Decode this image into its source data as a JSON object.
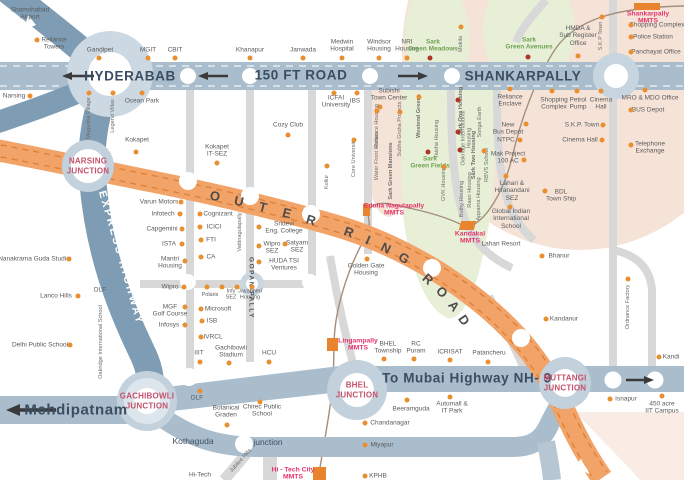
{
  "colors": {
    "outer_ring_road": "#f2a368",
    "orr_dash": "#dd7f35",
    "highway_band": "#a9bdcc",
    "express_highway": "#7e9db4",
    "minor_road": "#d8d8d8",
    "green_zone": "#e7f0d6",
    "peach_zone": "#f6e3d8",
    "junction_ring": "#c3d1dc",
    "label_text": "#5b5b5b",
    "green_label": "#6fa052",
    "mmts_label": "#e5336b",
    "junction_label": "#c4526b",
    "poi_dot": "#ea8f2f",
    "dark_dot": "#ae352a",
    "band_text": "#3b4d61"
  },
  "roads": {
    "hyderabad": "HYDERABAB",
    "road150": "150 FT ROAD",
    "shankarpally": "SHANKARPALLY",
    "nh9": "To Mubai Highway NH- 9",
    "mehdipatnam": "Mehdipatnam",
    "express": "EXPRESS HIGHWAY",
    "orr": "OUTER RING ROAD",
    "orr_letters": [
      {
        "ch": "O",
        "x": 215,
        "y": 196,
        "r": 12
      },
      {
        "ch": "U",
        "x": 239,
        "y": 201,
        "r": 13
      },
      {
        "ch": "T",
        "x": 263,
        "y": 207,
        "r": 14
      },
      {
        "ch": "E",
        "x": 287,
        "y": 213,
        "r": 15
      },
      {
        "ch": "R",
        "x": 311,
        "y": 220,
        "r": 17
      },
      {
        "ch": "R",
        "x": 349,
        "y": 232,
        "r": 20
      },
      {
        "ch": "I",
        "x": 368,
        "y": 240,
        "r": 23
      },
      {
        "ch": "N",
        "x": 386,
        "y": 248,
        "r": 26
      },
      {
        "ch": "G",
        "x": 404,
        "y": 258,
        "r": 30
      },
      {
        "ch": "R",
        "x": 428,
        "y": 279,
        "r": 42
      },
      {
        "ch": "O",
        "x": 442,
        "y": 292,
        "r": 46
      },
      {
        "ch": "A",
        "x": 454,
        "y": 306,
        "r": 50
      },
      {
        "ch": "D",
        "x": 464,
        "y": 320,
        "r": 55
      }
    ]
  },
  "junctions": [
    {
      "name": "narsing-junction",
      "label": "NARSING\nJUNCTION",
      "x": 88,
      "y": 166
    },
    {
      "name": "gachibowli-junction",
      "label": "GACHIBOWLI\nJUNCTION",
      "x": 147,
      "y": 401
    },
    {
      "name": "bhel-junction",
      "label": "BHEL\nJUNCTION",
      "x": 357,
      "y": 390
    },
    {
      "name": "muttangi-junction",
      "label": "MUTTANGI\nJUNCTION",
      "x": 565,
      "y": 383
    }
  ],
  "mmts_stations": [
    {
      "label": "Shankarpally\nMMTS",
      "x": 648,
      "y": 18,
      "block": [
        634,
        3,
        26,
        7,
        0
      ]
    },
    {
      "label": "Edulla Nagulapally\nMMTS",
      "x": 394,
      "y": 210,
      "block": [
        363,
        204,
        7,
        12,
        0
      ]
    },
    {
      "label": "Kandakal\nMMTS",
      "x": 470,
      "y": 238,
      "block": [
        460,
        221,
        15,
        9,
        -15
      ]
    },
    {
      "label": "Lingampally\nMMTS",
      "x": 358,
      "y": 345,
      "block": [
        327,
        338,
        11,
        13,
        0
      ]
    },
    {
      "label": "Hi - Tech City\nMMTS",
      "x": 293,
      "y": 474,
      "block": [
        313,
        467,
        13,
        13,
        0
      ]
    }
  ],
  "labels": [
    {
      "t": "Shamshabad\nAirport",
      "x": 30,
      "y": 14
    },
    {
      "t": "Reliance\nTowers",
      "x": 54,
      "y": 44,
      "d": [
        37,
        40
      ]
    },
    {
      "t": "Gandipet",
      "x": 100,
      "y": 50,
      "d": [
        99,
        58
      ]
    },
    {
      "t": "MGIT",
      "x": 148,
      "y": 50,
      "d": [
        148,
        58
      ]
    },
    {
      "t": "CBIT",
      "x": 175,
      "y": 50,
      "d": [
        175,
        58
      ]
    },
    {
      "t": "Narsing",
      "x": 14,
      "y": 96,
      "d": [
        30,
        96
      ]
    },
    {
      "t": "Khanapur",
      "x": 250,
      "y": 50,
      "d": [
        250,
        58
      ]
    },
    {
      "t": "Janwada",
      "x": 303,
      "y": 50,
      "d": [
        303,
        58
      ]
    },
    {
      "t": "Medwin\nHospital",
      "x": 342,
      "y": 46,
      "d": [
        342,
        58
      ]
    },
    {
      "t": "Windsor\nHousing",
      "x": 379,
      "y": 46,
      "d": [
        379,
        58
      ]
    },
    {
      "t": "NRI\nHousing",
      "x": 407,
      "y": 46,
      "d": [
        407,
        58
      ]
    },
    {
      "t": "Sark\nGreen Meadows",
      "x": 433,
      "y": 46,
      "c": "g",
      "d": [
        430,
        58,
        "r"
      ]
    },
    {
      "t": "Sark\nGreen Avenues",
      "x": 529,
      "y": 44,
      "c": "g",
      "d": [
        528,
        57,
        "r"
      ]
    },
    {
      "t": "HMDA &\nSub Register\nOffice",
      "x": 578,
      "y": 36,
      "d": [
        578,
        56
      ]
    },
    {
      "t": "Shopping Complex",
      "x": 657,
      "y": 25,
      "d": [
        631,
        25
      ]
    },
    {
      "t": "Police Station",
      "x": 653,
      "y": 37,
      "d": [
        631,
        37
      ]
    },
    {
      "t": "Panchayat Office",
      "x": 656,
      "y": 52,
      "d": [
        631,
        52
      ]
    },
    {
      "t": "Ocean Park",
      "x": 142,
      "y": 101,
      "d": [
        142,
        93
      ]
    },
    {
      "t": "Kokapet",
      "x": 137,
      "y": 140,
      "d": [
        136,
        152
      ]
    },
    {
      "t": "Cozy Club",
      "x": 288,
      "y": 125,
      "d": [
        288,
        135
      ]
    },
    {
      "t": "ICFAI\nUniversity",
      "x": 336,
      "y": 102,
      "d": [
        334,
        93
      ]
    },
    {
      "t": "IBS",
      "x": 355,
      "y": 101,
      "d": [
        357,
        93
      ]
    },
    {
      "t": "Subishi\nTown Center",
      "x": 389,
      "y": 95,
      "d": [
        380,
        107
      ]
    },
    {
      "t": "Kokapet\nIT-SEZ",
      "x": 217,
      "y": 151,
      "d": [
        217,
        163
      ]
    },
    {
      "t": "Varun Motors",
      "x": 159,
      "y": 202,
      "d": [
        181,
        202
      ]
    },
    {
      "t": "Infotech",
      "x": 163,
      "y": 214,
      "d": [
        180,
        214
      ]
    },
    {
      "t": "Capgemini",
      "x": 162,
      "y": 229,
      "d": [
        182,
        229
      ]
    },
    {
      "t": "ISTA",
      "x": 169,
      "y": 244,
      "d": [
        182,
        244
      ]
    },
    {
      "t": "Mantri\nHousing",
      "x": 170,
      "y": 263,
      "d": [
        185,
        261
      ]
    },
    {
      "t": "Wipro",
      "x": 170,
      "y": 287,
      "d": [
        184,
        287
      ]
    },
    {
      "t": "MGF\nGolf Course",
      "x": 170,
      "y": 311,
      "d": [
        185,
        307
      ]
    },
    {
      "t": "Infosys",
      "x": 169,
      "y": 325,
      "d": [
        185,
        325
      ]
    },
    {
      "t": "Cognizant",
      "x": 218,
      "y": 214,
      "d": [
        200,
        214
      ]
    },
    {
      "t": "ICICI",
      "x": 214,
      "y": 227,
      "d": [
        200,
        227
      ]
    },
    {
      "t": "FTI",
      "x": 211,
      "y": 240,
      "d": [
        201,
        240
      ]
    },
    {
      "t": "CA",
      "x": 211,
      "y": 257,
      "d": [
        201,
        257
      ]
    },
    {
      "t": "Sridevi\nEng. College",
      "x": 284,
      "y": 228,
      "d": [
        259,
        227
      ]
    },
    {
      "t": "Wipro\nSEZ",
      "x": 272,
      "y": 248,
      "d": [
        259,
        246
      ]
    },
    {
      "t": "Satyam\nSEZ",
      "x": 297,
      "y": 247,
      "d": [
        285,
        244
      ]
    },
    {
      "t": "HUDA TSI\nVentures",
      "x": 284,
      "y": 265,
      "d": [
        259,
        262
      ]
    },
    {
      "t": "Polaris",
      "x": 210,
      "y": 295,
      "c": "sm"
    },
    {
      "t": "Infy\nSEZ",
      "x": 231,
      "y": 295,
      "c": "sm"
    },
    {
      "t": "Jayabheri\nHousing",
      "x": 250,
      "y": 295,
      "c": "sm"
    },
    {
      "t": "Microsoft",
      "x": 218,
      "y": 309,
      "d": [
        201,
        309
      ]
    },
    {
      "t": "ISB",
      "x": 212,
      "y": 321,
      "d": [
        202,
        321
      ]
    },
    {
      "t": "IVRCL",
      "x": 213,
      "y": 337,
      "d": [
        201,
        337
      ]
    },
    {
      "t": "IIIT",
      "x": 199,
      "y": 353,
      "d": [
        200,
        362
      ]
    },
    {
      "t": "Gachibowli\nStadium",
      "x": 231,
      "y": 352,
      "d": [
        229,
        363
      ]
    },
    {
      "t": "HCU",
      "x": 269,
      "y": 353,
      "d": [
        269,
        362
      ]
    },
    {
      "t": "Nanakrama Guda Studio",
      "x": 34,
      "y": 259,
      "d": [
        69,
        259
      ]
    },
    {
      "t": "Lanco Hills",
      "x": 56,
      "y": 296,
      "d": [
        78,
        296
      ]
    },
    {
      "t": "Delhi Public School",
      "x": 40,
      "y": 345,
      "d": [
        70,
        345
      ]
    },
    {
      "t": "DLF",
      "x": 100,
      "y": 290
    },
    {
      "t": "DLF",
      "x": 197,
      "y": 398,
      "d": [
        200,
        391
      ]
    },
    {
      "t": "Botanical\nGraden",
      "x": 226,
      "y": 412,
      "d": [
        227,
        425
      ]
    },
    {
      "t": "Chirec Public\nSchool",
      "x": 262,
      "y": 411,
      "d": [
        260,
        402
      ]
    },
    {
      "t": "Golden Gate\nHousing",
      "x": 366,
      "y": 270,
      "d": [
        367,
        259
      ]
    },
    {
      "t": "Sark\nGreen Fields",
      "x": 430,
      "y": 163,
      "c": "g",
      "d": [
        428,
        152,
        "r"
      ]
    },
    {
      "t": "BHEL\nTownship",
      "x": 388,
      "y": 348,
      "d": [
        384,
        359
      ]
    },
    {
      "t": "RC\nPuram",
      "x": 416,
      "y": 348,
      "d": [
        414,
        359
      ]
    },
    {
      "t": "ICRISAT",
      "x": 450,
      "y": 352,
      "d": [
        450,
        360
      ]
    },
    {
      "t": "Patancheru",
      "x": 489,
      "y": 353,
      "d": [
        488,
        362
      ]
    },
    {
      "t": "Beeramguda",
      "x": 411,
      "y": 409,
      "d": [
        407,
        400
      ]
    },
    {
      "t": "Automall &\nIT Park",
      "x": 452,
      "y": 408,
      "d": [
        450,
        397
      ]
    },
    {
      "t": "Chandanagar",
      "x": 390,
      "y": 423,
      "d": [
        365,
        423
      ]
    },
    {
      "t": "Miyapur",
      "x": 382,
      "y": 445,
      "d": [
        365,
        445
      ]
    },
    {
      "t": "KPHB",
      "x": 378,
      "y": 476,
      "d": [
        365,
        476
      ]
    },
    {
      "t": "Hi-Tech",
      "x": 200,
      "y": 475
    },
    {
      "t": "Reliance\nEnclave",
      "x": 510,
      "y": 101,
      "d": [
        510,
        89
      ]
    },
    {
      "t": "New\nBus Depot",
      "x": 508,
      "y": 129,
      "d": [
        526,
        124
      ]
    },
    {
      "t": "NTPC",
      "x": 506,
      "y": 140,
      "d": [
        520,
        140
      ]
    },
    {
      "t": "Mak Project\n100 AC",
      "x": 508,
      "y": 158,
      "d": [
        524,
        160
      ]
    },
    {
      "t": "Lahari &\nHiranandani\nSEZ",
      "x": 512,
      "y": 191,
      "d": [
        506,
        176
      ]
    },
    {
      "t": "Global Indian\nInternational\nSchool",
      "x": 511,
      "y": 219,
      "d": [
        510,
        207
      ]
    },
    {
      "t": "Lahari Resort",
      "x": 501,
      "y": 244
    },
    {
      "t": "Shopping\nComplex",
      "x": 554,
      "y": 104,
      "d": [
        552,
        91
      ]
    },
    {
      "t": "Petrol\nPump",
      "x": 578,
      "y": 104,
      "d": [
        577,
        91
      ]
    },
    {
      "t": "Cinema\nHall",
      "x": 601,
      "y": 104,
      "d": [
        601,
        91
      ]
    },
    {
      "t": "S.K.P. Town",
      "x": 582,
      "y": 125,
      "d": [
        603,
        125
      ]
    },
    {
      "t": "Cinema Hall",
      "x": 580,
      "y": 140,
      "d": [
        602,
        140
      ]
    },
    {
      "t": "BDL\nTown Ship",
      "x": 561,
      "y": 196,
      "d": [
        545,
        191
      ]
    },
    {
      "t": "MRO & MDO Office",
      "x": 650,
      "y": 98,
      "d": [
        645,
        90
      ]
    },
    {
      "t": "BUS Depot",
      "x": 648,
      "y": 110,
      "d": [
        631,
        110
      ]
    },
    {
      "t": "Telephone\nExchange",
      "x": 650,
      "y": 148,
      "d": [
        631,
        145
      ]
    },
    {
      "t": "Bhanur",
      "x": 559,
      "y": 256,
      "d": [
        542,
        256
      ]
    },
    {
      "t": "Kandanur",
      "x": 564,
      "y": 319,
      "d": [
        546,
        319
      ]
    },
    {
      "t": "Kandi",
      "x": 671,
      "y": 357,
      "d": [
        659,
        357
      ]
    },
    {
      "t": "Isnapur",
      "x": 626,
      "y": 399,
      "d": [
        610,
        399
      ]
    },
    {
      "t": "450 acre\nIIT Campus",
      "x": 662,
      "y": 408,
      "d": [
        662,
        396
      ]
    },
    {
      "t": "Kothaguda",
      "x": 193,
      "y": 442,
      "c": "onband"
    },
    {
      "t": "junction",
      "x": 268,
      "y": 443,
      "c": "onband"
    }
  ],
  "vertical_labels": [
    {
      "t": "Magadha Village",
      "x": 89,
      "y": 118,
      "d": [
        89,
        93
      ]
    },
    {
      "t": "Legend Villas",
      "x": 113,
      "y": 116,
      "d": [
        113,
        93
      ]
    },
    {
      "t": "Oakridge International School",
      "x": 101,
      "y": 342
    },
    {
      "t": "Vattinagulapally",
      "x": 240,
      "y": 232
    },
    {
      "t": "Reliance Housing",
      "x": 377,
      "y": 126,
      "d": [
        377,
        111
      ]
    },
    {
      "t": "Water Front Homes",
      "x": 377,
      "y": 156
    },
    {
      "t": "Subha Gruha Projects",
      "x": 400,
      "y": 129,
      "d": [
        400,
        112
      ]
    },
    {
      "t": "Sark Green Mansions",
      "x": 391,
      "y": 171,
      "c": "g"
    },
    {
      "t": "Westend Greens",
      "x": 419,
      "y": 116,
      "c": "g",
      "d": [
        419,
        97
      ]
    },
    {
      "t": "Taisha Housing",
      "x": 437,
      "y": 139
    },
    {
      "t": "GVK Housing",
      "x": 444,
      "y": 184,
      "d": [
        444,
        167
      ]
    },
    {
      "t": "Sark One Housing",
      "x": 461,
      "y": 111,
      "c": "g"
    },
    {
      "t": "Oakridge International\nHousing",
      "x": 467,
      "y": 138
    },
    {
      "t": "Sark Two Housing",
      "x": 474,
      "y": 155,
      "c": "g"
    },
    {
      "t": "Songa Earth",
      "x": 480,
      "y": 122
    },
    {
      "t": "RBVS School",
      "x": 487,
      "y": 165,
      "d": [
        484,
        151
      ]
    },
    {
      "t": "Raan Housing",
      "x": 470,
      "y": 190
    },
    {
      "t": "Apparna Housing",
      "x": 479,
      "y": 199
    },
    {
      "t": "Buthy Housing",
      "x": 462,
      "y": 199
    },
    {
      "t": "S.K.P Town",
      "x": 601,
      "y": 36,
      "d": [
        602,
        17
      ]
    },
    {
      "t": "Mokila",
      "x": 461,
      "y": 44,
      "d": [
        461,
        27
      ]
    },
    {
      "t": "Core University",
      "x": 354,
      "y": 158,
      "d": [
        354,
        140
      ]
    },
    {
      "t": "Kollur",
      "x": 327,
      "y": 182,
      "d": [
        327,
        166
      ]
    },
    {
      "t": "Jubilee Hills",
      "x": 241,
      "y": 461,
      "rot": -48
    },
    {
      "t": "Ordnance Factory",
      "x": 628,
      "y": 307,
      "d": [
        628,
        279
      ]
    },
    {
      "t": "GOPAN PALLY",
      "x": 251,
      "y": 288,
      "rot": 90,
      "c": "road"
    }
  ],
  "extra_dots": [
    [
      458,
      100,
      "r"
    ],
    [
      458,
      132,
      "r"
    ],
    [
      460,
      150,
      "r"
    ],
    [
      207,
      287
    ],
    [
      222,
      287
    ],
    [
      237,
      287
    ],
    [
      252,
      287
    ]
  ]
}
